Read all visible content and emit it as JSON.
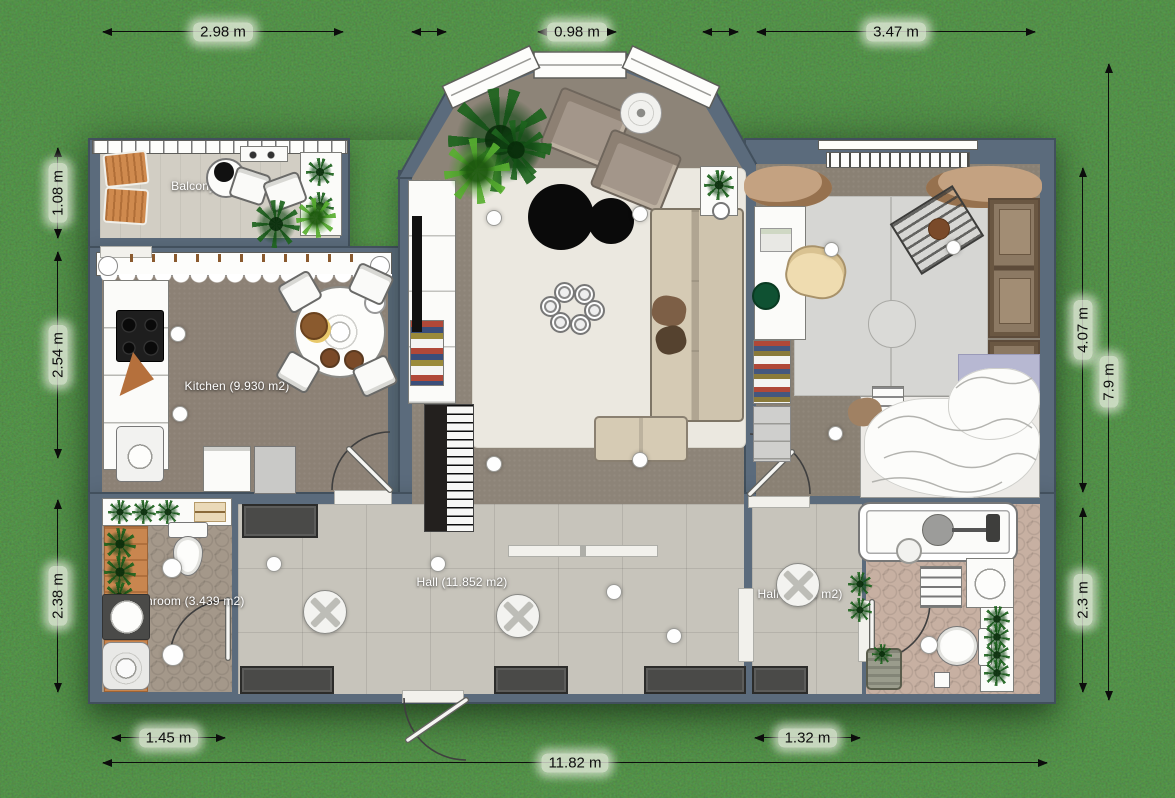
{
  "scene": {
    "type": "2d-floor-plan-render",
    "background": "grass",
    "colors": {
      "grass": "#4d7b3a",
      "wall": "#5b6b7c",
      "room_carpet": "#8c8175",
      "hall_tiles": "#c7c4bb",
      "bathroom1_floor": "#a4988a",
      "bathroom2_floor": "#c7b0a2",
      "balcony_floor": "#d2cec4",
      "living_rug": "#ebe8e0",
      "bedroom_rug": "#d6d6d3",
      "wood_accent": "#c9864f",
      "dimension_text": "#0d0d0d",
      "room_label_text": "#ffffff"
    }
  },
  "dimensions": {
    "top": [
      {
        "label": "2.98 m"
      },
      {
        "label": "0.98 m"
      },
      {
        "label": "3.47 m"
      }
    ],
    "left": [
      {
        "label": "1.08 m"
      },
      {
        "label": "2.54 m"
      },
      {
        "label": "2.38 m"
      }
    ],
    "right": [
      {
        "label": "4.07 m"
      },
      {
        "label": "7.9 m"
      },
      {
        "label": "2.3 m"
      }
    ],
    "bottom": [
      {
        "label": "1.45 m"
      },
      {
        "label": "1.32 m"
      },
      {
        "label": "11.82 m"
      }
    ]
  },
  "rooms": {
    "balcony": {
      "label": "Balcony (3.218 m2)"
    },
    "kitchen": {
      "label": "Kitchen (9.930 m2)"
    },
    "hall": {
      "label": "Hall (11.852 m2)"
    },
    "hall2": {
      "label": "Hall (3.036 m2)"
    },
    "bathroom1": {
      "label": "Bathroom (3.439 m2)"
    }
  }
}
